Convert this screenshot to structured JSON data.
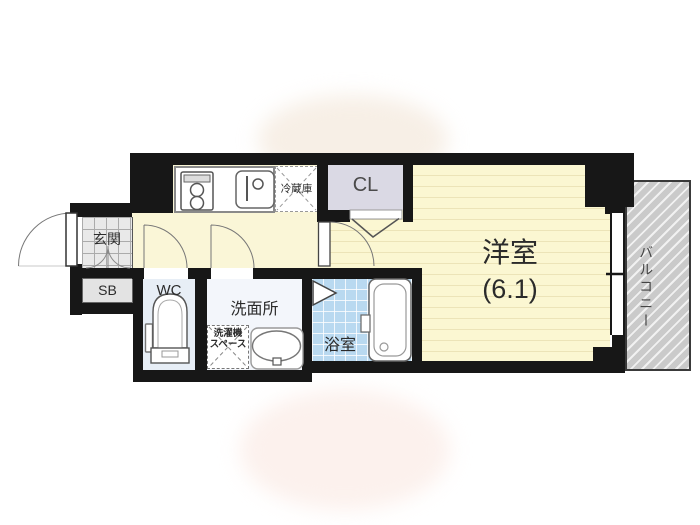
{
  "plan": {
    "type": "apartment-floor-plan",
    "rooms": {
      "entrance": {
        "label": "玄関"
      },
      "shoe_box": {
        "label": "SB"
      },
      "toilet": {
        "label": "WC"
      },
      "washroom": {
        "label": "洗面所"
      },
      "washer_space": {
        "line1": "洗濯機",
        "line2": "スペース"
      },
      "bathroom": {
        "label": "浴室"
      },
      "refrigerator_space": {
        "label": "冷蔵庫"
      },
      "closet": {
        "label": "CL"
      },
      "western_room": {
        "label": "洋室",
        "size": "(6.1)"
      },
      "balcony": {
        "label": "バルコニー"
      }
    },
    "colors": {
      "wall": "#171717",
      "floor_cream": "#faf6d7",
      "bedroom_stripe": "#ece4b8",
      "bath_tile": "#b9d9f0",
      "wc_floor": "#e7eef6",
      "washroom_floor": "#f3f6fb",
      "closet_fill": "#dad9e4",
      "entrance_tile": "#e9e9e9",
      "shoe_box_fill": "#e3e3e3",
      "balcony_fill": "#cacaca"
    }
  }
}
